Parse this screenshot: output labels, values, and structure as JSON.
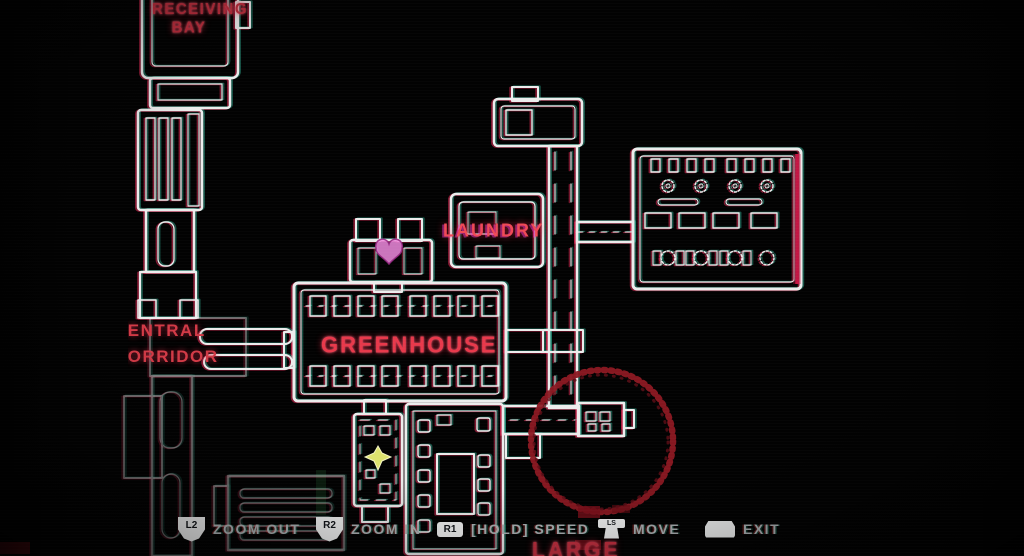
{
  "screen": "station-map",
  "colors": {
    "background": "#020202",
    "map_line": "#ececec",
    "chromatic_red": "#ff2d5f",
    "chromatic_cyan": "#46ffd7",
    "label_red": "#e23c4b",
    "objective_circle_red": "#8c1822",
    "player_marker_yellow": "#dde36e",
    "heart_marker_pink": "#ee8ade",
    "hud_text_gray": "#aeb3b6"
  },
  "map": {
    "labels": {
      "receiving_bay": {
        "line1": "RECEIVING",
        "line2": "BAY"
      },
      "central_corridor": {
        "line1": "CENTRAL",
        "line2": "CORRIDOR"
      },
      "greenhouse": "GREENHOUSE",
      "laundry": "LAUNDRY",
      "large": "LARGE"
    },
    "markers": {
      "objective_circle": "hand-drawn-red-circle",
      "heart": "heart-objective-marker",
      "player": "player-position-marker"
    }
  },
  "hud": {
    "zoom_out": {
      "button": "L2",
      "label": "ZOOM OUT"
    },
    "zoom_in": {
      "button": "R2",
      "label": "ZOOM IN"
    },
    "speed": {
      "button": "R1",
      "label": "[HOLD] SPEED"
    },
    "move": {
      "button": "LS",
      "label": "MOVE"
    },
    "exit": {
      "label": "EXIT"
    }
  }
}
